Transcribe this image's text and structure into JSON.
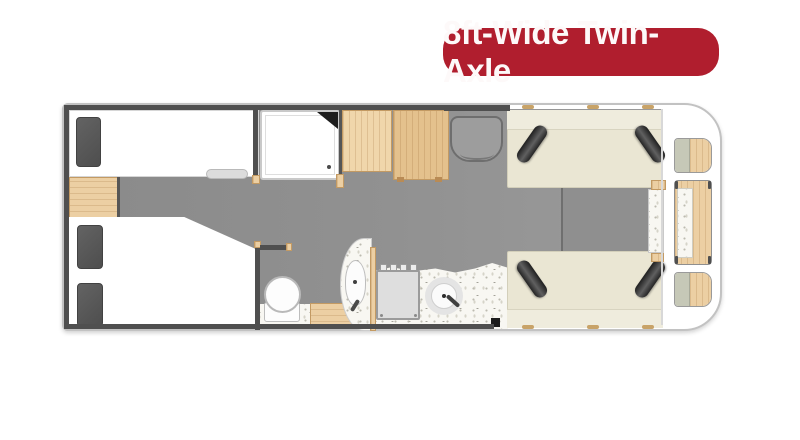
{
  "badge": {
    "label": "8ft-Wide Twin-Axle",
    "bg_color": "#b01e2e",
    "text_color": "#ffffff"
  },
  "plan": {
    "type": "caravan-floorplan-top-view",
    "colors": {
      "shell_white": "#ffffff",
      "floor_grey": "#919191",
      "wall_dark": "#4f4f4f",
      "wood_light": "#eccfa3",
      "sofa_cream": "#eae6d3",
      "cushion_dark": "#3a3a3a",
      "worktop_speckle": "#f8f7f2",
      "sage_front": "#c6c8b7"
    },
    "rooms": {
      "rear_bedroom": [
        "single-bed",
        "double-bed",
        "nightstand",
        "pillows",
        "bed-step"
      ],
      "shower_room": [
        "shower-tray",
        "corner-shelf",
        "drain"
      ],
      "wardrobe": [
        "wardrobe-left",
        "wardrobe-right"
      ],
      "entrance": [
        "door-recess"
      ],
      "washroom": [
        "toilet",
        "vanity-basin",
        "tap",
        "wood-step"
      ],
      "kitchen": [
        "worktop",
        "cooker",
        "round-sink",
        "tap",
        "bin"
      ],
      "front_lounge": [
        "sofa-top",
        "sofa-bottom",
        "bolster-cushions",
        "mid-table",
        "side-table"
      ],
      "front_storage": [
        "corner-shelf-top",
        "front-chest",
        "corner-shelf-bottom"
      ]
    }
  }
}
